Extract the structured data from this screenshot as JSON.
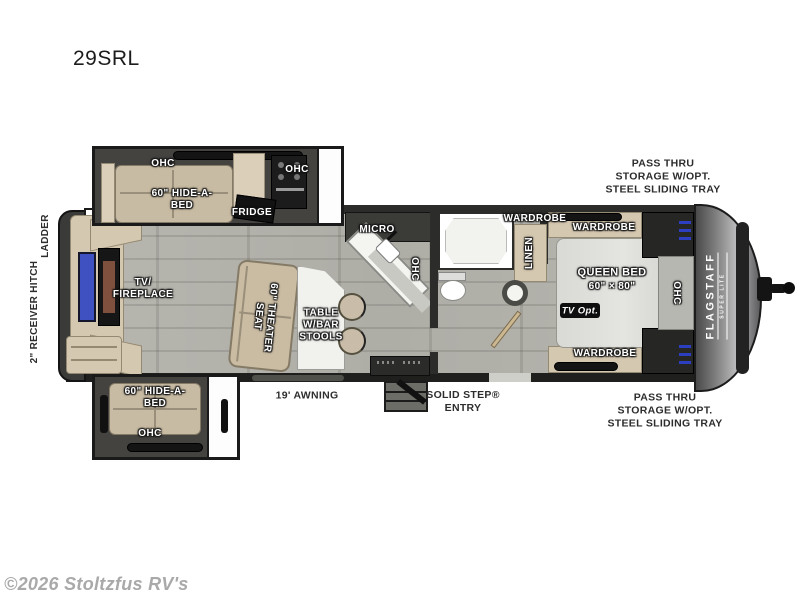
{
  "title": "29SRL",
  "watermark": "©2026 Stoltzfus RV's",
  "exterior": {
    "ladder": "LADDER",
    "hitch": "2\" RECEIVER HITCH",
    "awning": "19' AWNING",
    "entry": "SOLID STEP®\nENTRY",
    "pass_thru_top": "PASS THRU\nSTORAGE W/OPT.\nSTEEL SLIDING TRAY",
    "pass_thru_bottom": "PASS THRU\nSTORAGE W/OPT.\nSTEEL SLIDING TRAY",
    "brand": "FLAGSTAFF",
    "brand_sub": "SUPER LITE"
  },
  "living": {
    "tv_fireplace": "TV/\nFIREPLACE",
    "theater_seat": "60\" THEATER\nSEAT",
    "table": "TABLE\nW/BAR\nSTOOLS",
    "slide_top_ohc": "OHC",
    "slide_top_bed": "60\" HIDE-A-\nBED",
    "slide_bottom_bed": "60\" HIDE-A-\nBED",
    "slide_bottom_ohc": "OHC"
  },
  "kitchen": {
    "fridge": "FRIDGE",
    "ohc_range": "OHC",
    "micro": "MICRO",
    "ohc_counter": "OHC"
  },
  "bath": {
    "wardrobe": "WARDROBE",
    "linen": "LINEN"
  },
  "bedroom": {
    "wardrobe_top": "WARDROBE",
    "wardrobe_bottom": "WARDROBE",
    "queen_bed": "QUEEN BED",
    "bed_size": "60\" × 80\"",
    "tv_opt": "TV Opt.",
    "ohc": "OHC"
  },
  "colors": {
    "accent_blue": "#3f51c0",
    "wood_floor": "#b4b3ac",
    "cabinet_tan": "#d5c8b1",
    "wall_dark": "#2c2c2a",
    "front_cap": "#8f8f91"
  }
}
